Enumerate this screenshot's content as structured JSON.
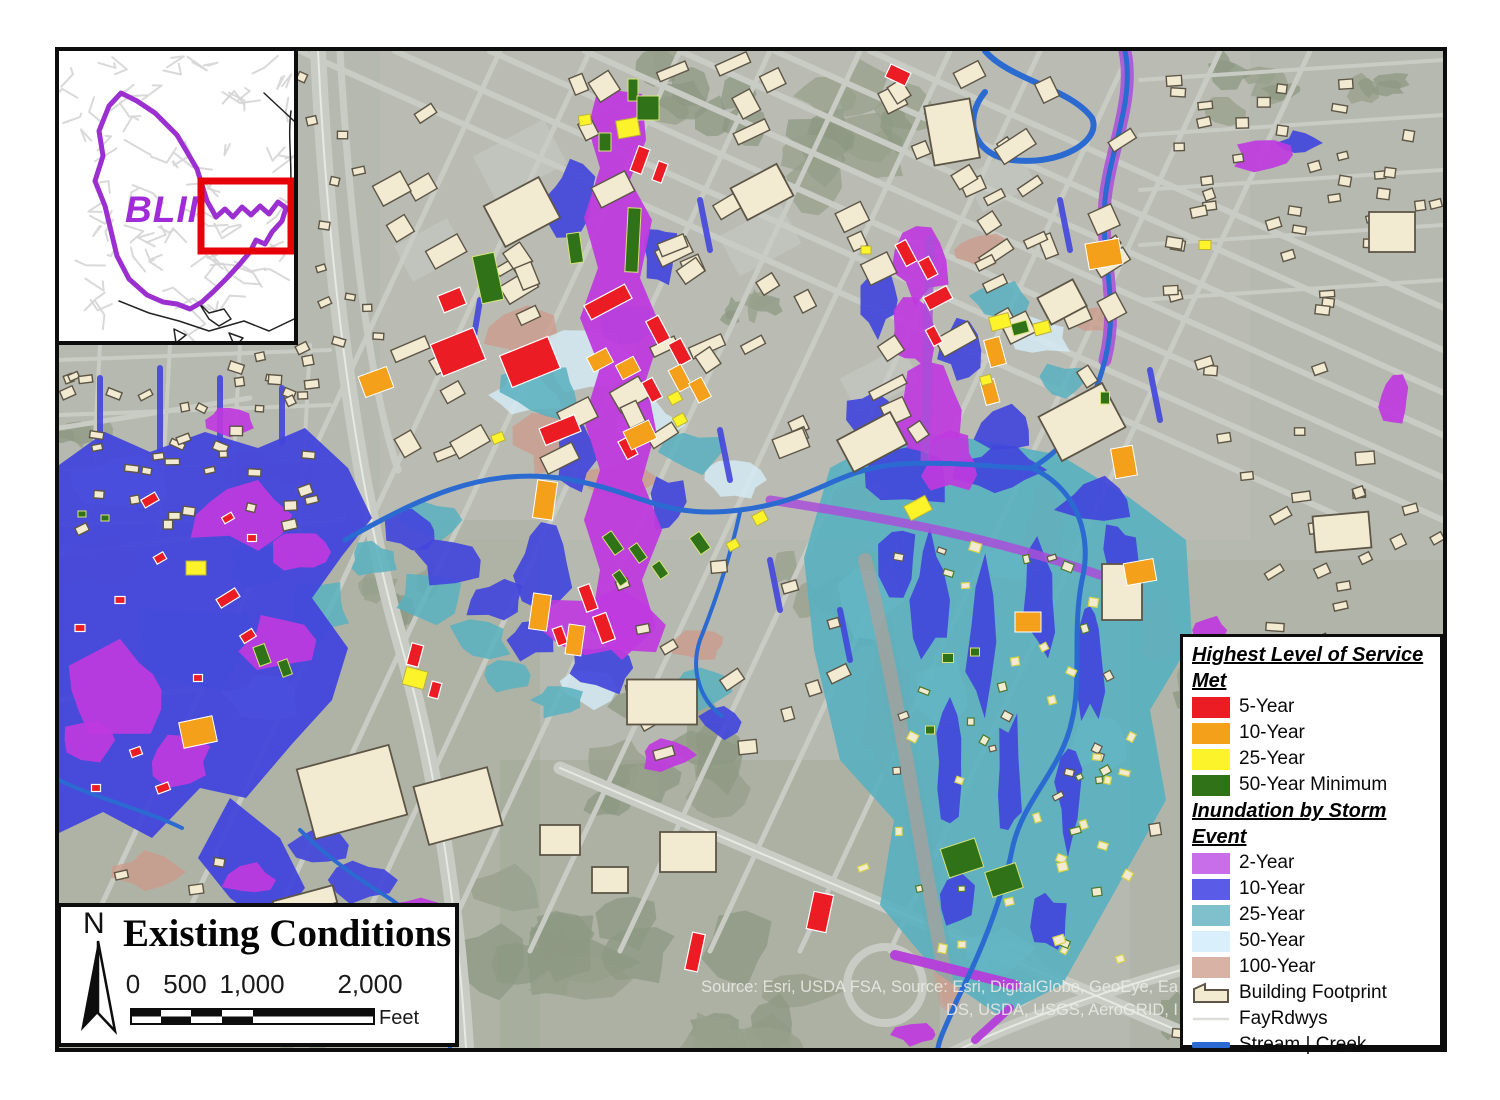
{
  "inset": {
    "label": "BLII"
  },
  "title_box": {
    "north_label": "N",
    "title": "Existing Conditions",
    "scale_ticks": [
      "0",
      "500",
      "1,000",
      "2,000"
    ],
    "unit_label": "Feet"
  },
  "legend": {
    "heading_los_line1": "Highest Level of Service",
    "heading_los_line2": "Met",
    "los_items": [
      {
        "label": "5-Year",
        "color": "#ec1c24"
      },
      {
        "label": "10-Year",
        "color": "#f4a01a"
      },
      {
        "label": "25-Year",
        "color": "#fdf32a"
      },
      {
        "label": "50-Year Minimum",
        "color": "#2f7218"
      }
    ],
    "heading_storm_line1": "Inundation by Storm",
    "heading_storm_line2": "Event",
    "storm_items": [
      {
        "label": "2-Year",
        "color": "#c76ee8"
      },
      {
        "label": "10-Year",
        "color": "#5a5ce8"
      },
      {
        "label": "25-Year",
        "color": "#7fc0cc"
      },
      {
        "label": "50-Year",
        "color": "#d9effb"
      },
      {
        "label": "100-Year",
        "color": "#d9b2a6"
      }
    ],
    "other_items": [
      {
        "label": "Building Footprint",
        "type": "polygon"
      },
      {
        "label": "FayRdwys",
        "type": "thin-line"
      },
      {
        "label": "Stream | Creek",
        "type": "thick-line"
      }
    ]
  },
  "source": {
    "line1": "Source: Esri, USDA FSA,  Source: Esri, DigitalGlobe, GeoEye, Ea",
    "line2": "DS, USDA, USGS, AeroGRID, I"
  },
  "colors": {
    "los_red": "#ec1c24",
    "los_orange": "#f4a01a",
    "los_yellow": "#fdf32a",
    "los_green": "#2f7218",
    "map_magenta": "#bf3ade",
    "map_blue": "#4246db",
    "map_teal": "#58b0c0",
    "map_lightblue": "#d6ecf8",
    "map_tan": "#cc9a8a",
    "building_fill": "#f3ead2",
    "building_stroke": "#5d5646",
    "stream": "#2b6ad0",
    "road": "#c9ccc4",
    "road_center": "#e9ebe5",
    "base": "#b6b9b0",
    "trees": "#97a08b",
    "inset_boundary": "#9b2fd0",
    "inset_extent": "#e60008",
    "inset_label": "#a12bd8",
    "fayrdwys_line": "#dcdcd8"
  }
}
